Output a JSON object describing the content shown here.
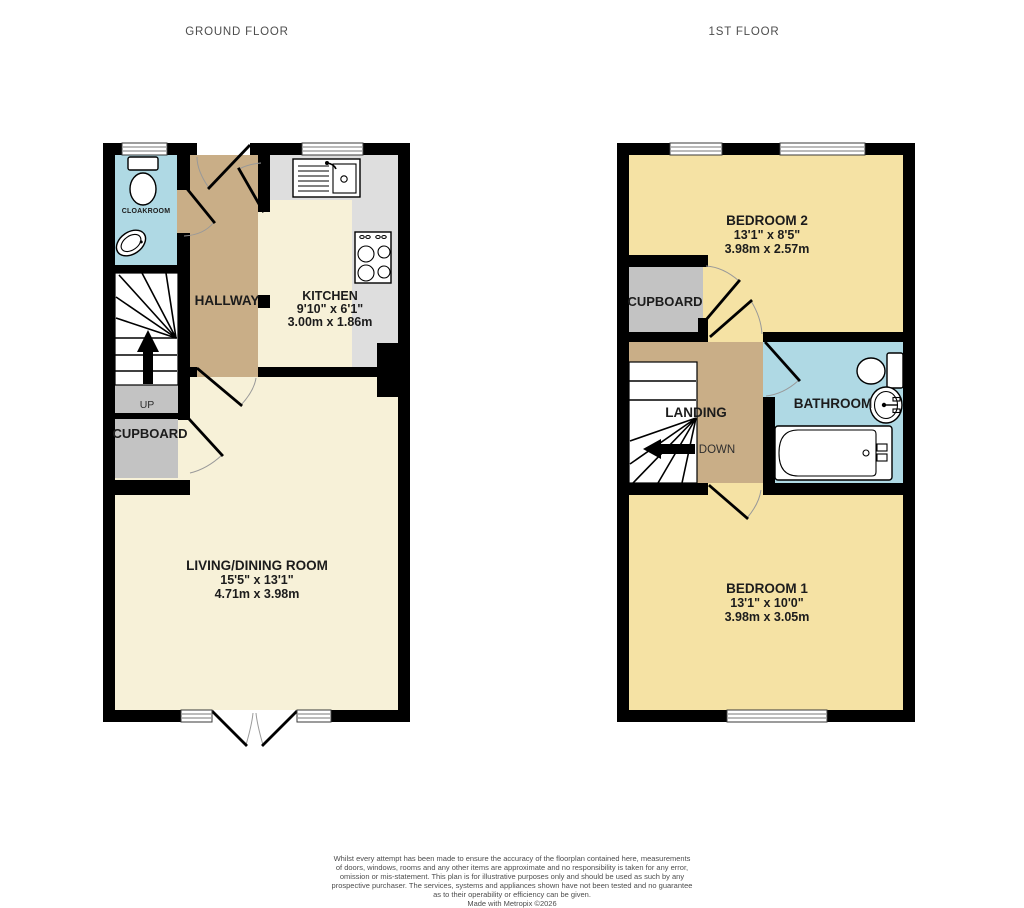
{
  "ground": {
    "title": "GROUND FLOOR",
    "cloakroom": {
      "name": "CLOAKROOM"
    },
    "hallway": {
      "name": "HALLWAY"
    },
    "kitchen": {
      "name": "KITCHEN",
      "size_imperial": "9'10\"  x 6'1\"",
      "size_metric": "3.00m  x 1.86m"
    },
    "stairs": {
      "direction": "UP"
    },
    "cupboard": {
      "name": "CUPBOARD"
    },
    "living_dining": {
      "name": "LIVING/DINING ROOM",
      "size_imperial": "15'5\"  x 13'1\"",
      "size_metric": "4.71m  x 3.98m"
    }
  },
  "first": {
    "title": "1ST FLOOR",
    "bedroom2": {
      "name": "BEDROOM 2",
      "size_imperial": "13'1\"  x 8'5\"",
      "size_metric": "3.98m  x 2.57m"
    },
    "cupboard": {
      "name": "CUPBOARD"
    },
    "landing": {
      "name": "LANDING"
    },
    "stairs": {
      "direction": "DOWN"
    },
    "bathroom": {
      "name": "BATHROOM"
    },
    "bedroom1": {
      "name": "BEDROOM 1",
      "size_imperial": "13'1\"  x 10'0\"",
      "size_metric": "3.98m  x 3.05m"
    }
  },
  "footer": {
    "disclaimer_lines": [
      "Whilst every attempt has been made to ensure the accuracy of the floorplan contained here, measurements",
      "of doors, windows, rooms and any other items are approximate and no responsibility is taken for any error,",
      "omission or mis-statement. This plan is for illustrative purposes only and should be used as such by any",
      "prospective purchaser. The services, systems and appliances shown have not been tested and no guarantee",
      "as to their operability or efficiency can be given."
    ],
    "credit": "Made with Metropix ©2026"
  },
  "colors": {
    "wall": "#000000",
    "floor_cream": "#F7F1D8",
    "floor_yellow": "#F5E2A4",
    "floor_tan": "#C9AE87",
    "floor_blue": "#AFD9E4",
    "floor_gray": "#C3C3C3",
    "counter_gray": "#DEDEDE"
  }
}
